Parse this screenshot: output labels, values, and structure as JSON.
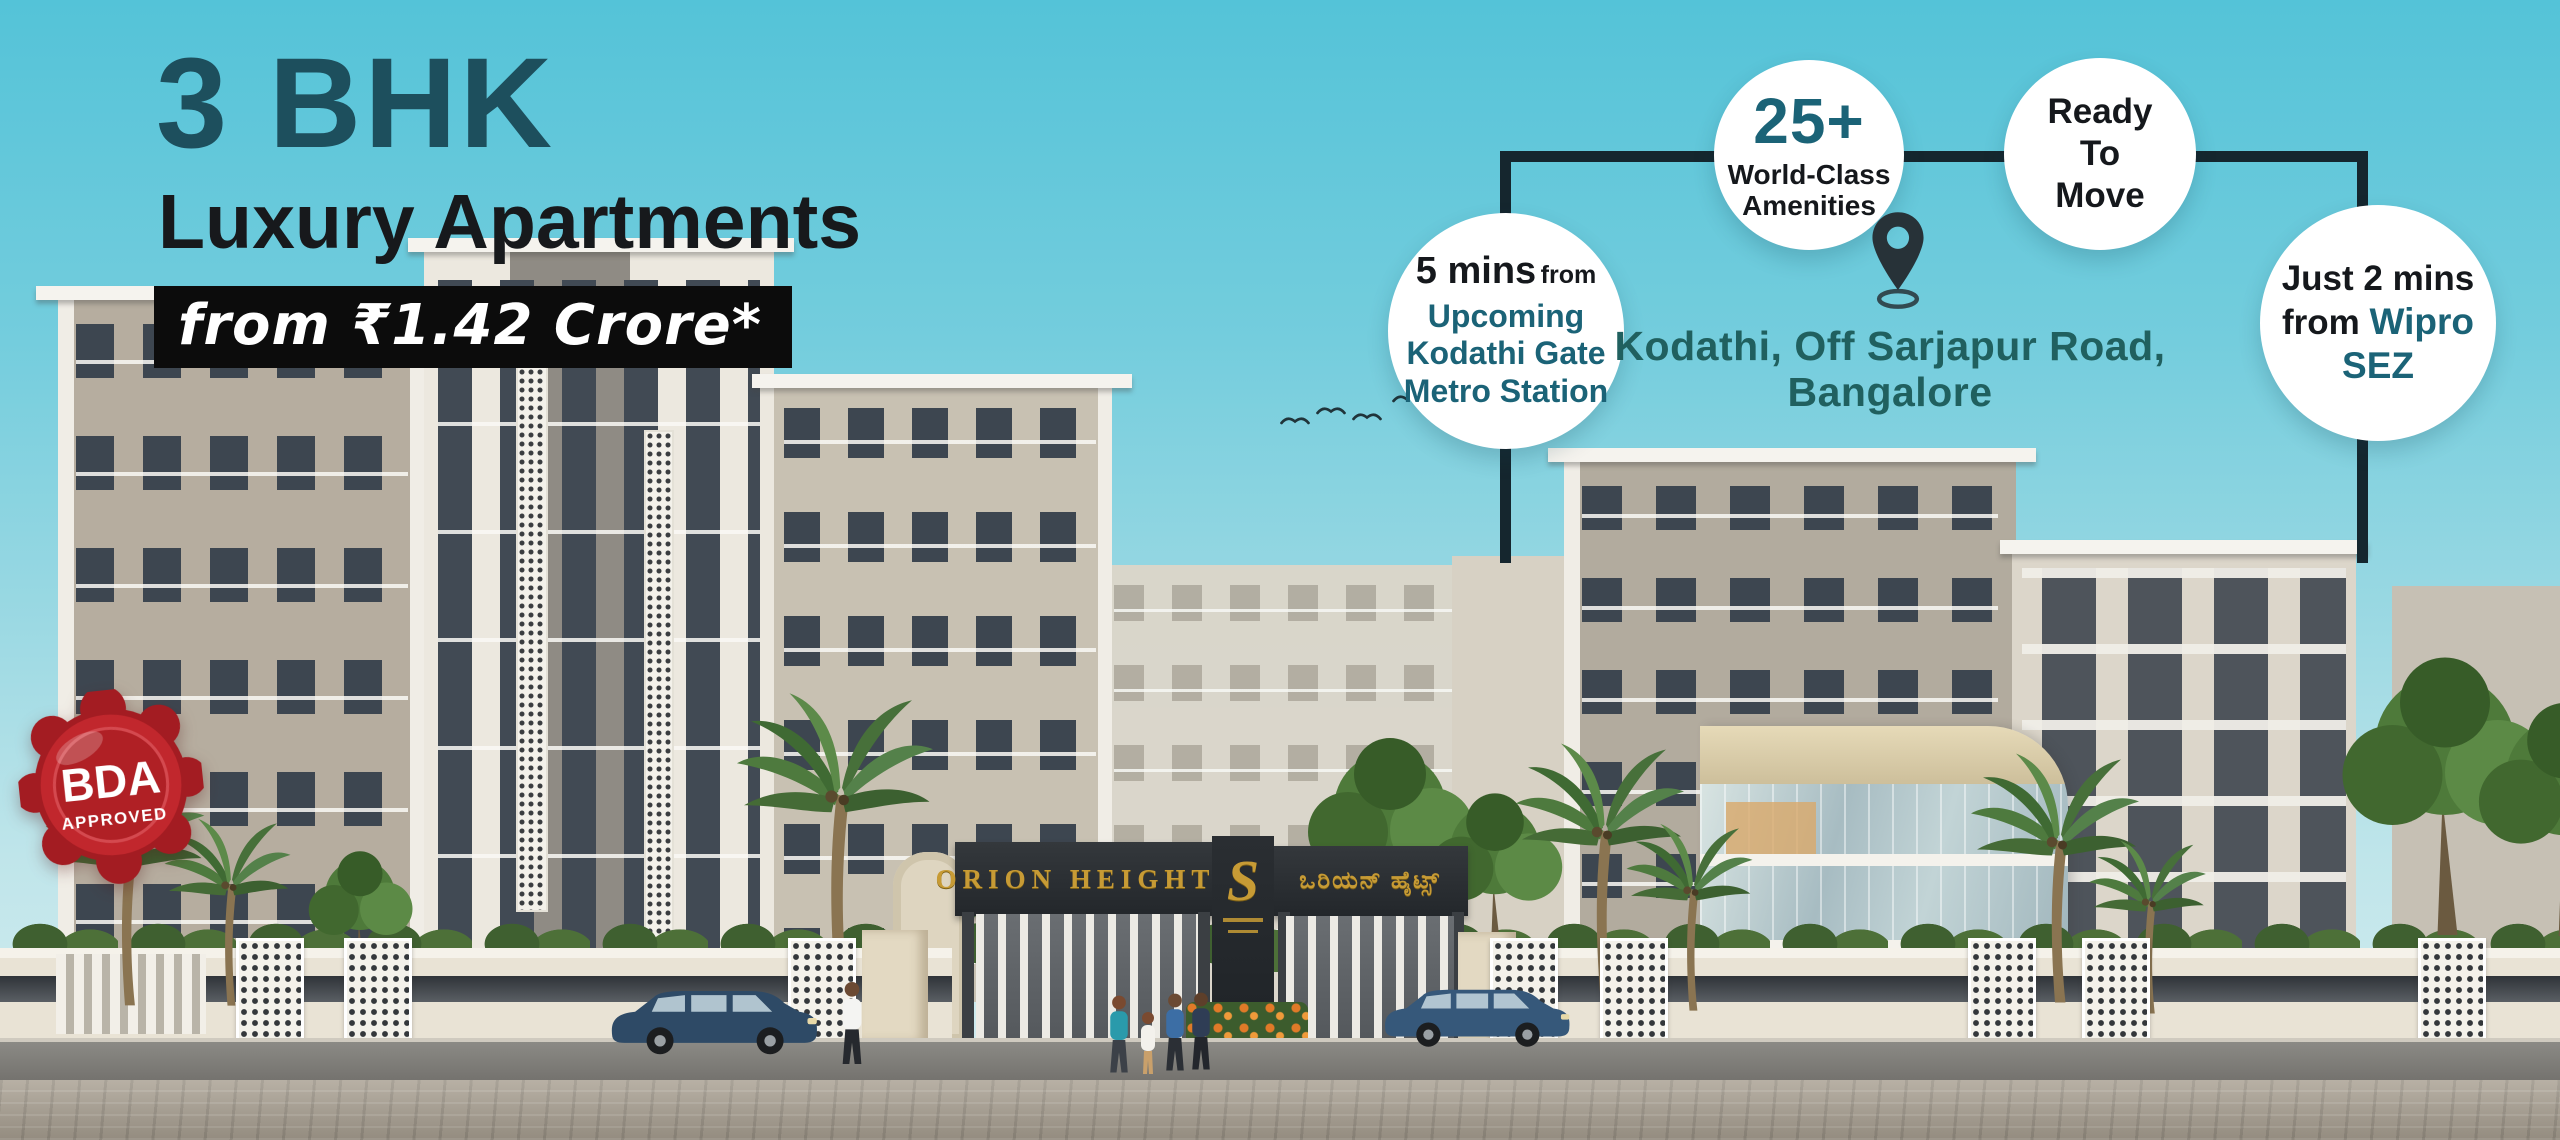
{
  "headline": {
    "bhk": "3 BHK",
    "subtitle": "Luxury Apartments",
    "price": "from ₹1.42 Crore*"
  },
  "approval_badge": {
    "title": "BDA",
    "subtitle": "APPROVED"
  },
  "callouts": {
    "metro": {
      "duration": "5 mins",
      "connector": "from",
      "destination": "Upcoming Kodathi Gate Metro Station"
    },
    "amenities": {
      "count": "25+",
      "label": "World-Class Amenities"
    },
    "possession": {
      "label": "Ready To Move"
    },
    "wipro": {
      "prefix": "Just 2 mins from",
      "destination": "Wipro SEZ"
    }
  },
  "location": {
    "line1": "Kodathi, Off Sarjapur Road,",
    "line2": "Bangalore"
  },
  "project": {
    "name_english": "ORION HEIGHTS",
    "name_kannada": "ಒರಿಯನ್ ಹೈಟ್ಸ್",
    "monogram": "S"
  },
  "colors": {
    "teal_accent": "#1b6377",
    "headline_teal": "#1d4f5d",
    "text_dark": "#15181c",
    "connector_line": "#15262e",
    "badge_red": "#c1272d",
    "gold": "#c79b35",
    "price_bg": "#0c0c0c",
    "price_text": "#ffffff"
  }
}
